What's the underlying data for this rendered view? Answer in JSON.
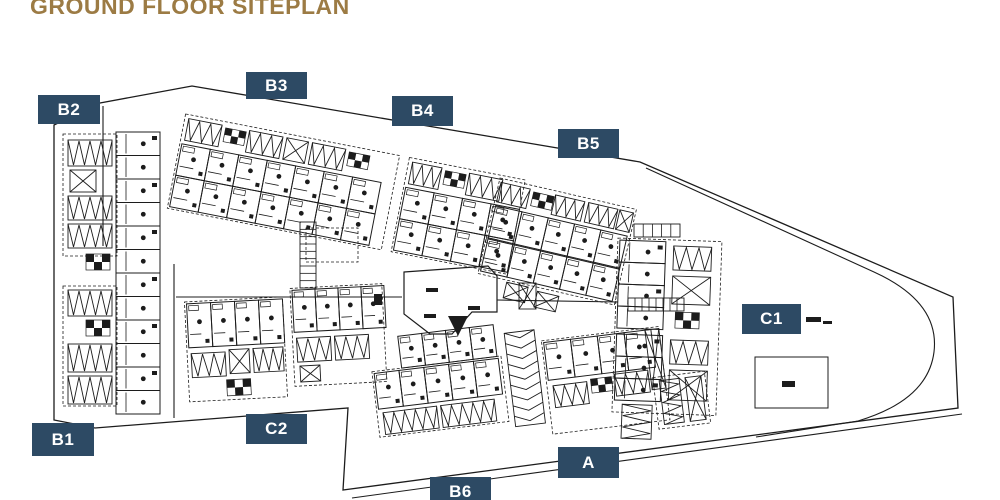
{
  "title": {
    "text": "GROUND FLOOR SITEPLAN",
    "color": "#9c7b44"
  },
  "badges": {
    "bg_color": "#2d4a64",
    "text_color": "#ffffff",
    "items": [
      {
        "id": "B2",
        "label": "B2",
        "x": 38,
        "y": 95,
        "w": 62,
        "h": 29
      },
      {
        "id": "B3",
        "label": "B3",
        "x": 246,
        "y": 72,
        "w": 61,
        "h": 27
      },
      {
        "id": "B4",
        "label": "B4",
        "x": 392,
        "y": 96,
        "w": 61,
        "h": 30
      },
      {
        "id": "B5",
        "label": "B5",
        "x": 558,
        "y": 129,
        "w": 61,
        "h": 29
      },
      {
        "id": "C1",
        "label": "C1",
        "x": 742,
        "y": 304,
        "w": 59,
        "h": 30
      },
      {
        "id": "B1",
        "label": "B1",
        "x": 32,
        "y": 423,
        "w": 62,
        "h": 33
      },
      {
        "id": "C2",
        "label": "C2",
        "x": 246,
        "y": 414,
        "w": 61,
        "h": 30
      },
      {
        "id": "A",
        "label": "A",
        "x": 558,
        "y": 447,
        "w": 61,
        "h": 31
      },
      {
        "id": "B6",
        "label": "B6",
        "x": 430,
        "y": 477,
        "w": 61,
        "h": 30
      }
    ]
  },
  "plan": {
    "stroke_color": "#1c1c1c",
    "boundary": "54,125 100,103 192,86 640,162 953,297 958,408 343,490 348,408 95,428 54,420",
    "roads": [
      "M646,168 L874,272 Q940,302 934,352 Q928,400 858,421 L756,437",
      "M352,498 L962,414",
      "M174,264 L174,418",
      "M103,106 L103,246",
      "M176,297 L402,297",
      "M497,300 L618,302"
    ],
    "clusters": [
      {
        "id": "block-b2-b1-strip",
        "x": 62,
        "y": 128,
        "angle": 0,
        "items": [
          {
            "t": "drect",
            "x": 1,
            "y": 6,
            "w": 54,
            "h": 122
          },
          {
            "t": "drect",
            "x": 1,
            "y": 158,
            "w": 54,
            "h": 120
          },
          {
            "t": "ucol",
            "x": 54,
            "y": 4,
            "n": 12,
            "cw": 44,
            "ch": 23.5
          },
          {
            "t": "zig",
            "x": 6,
            "y": 12,
            "w": 44,
            "h": 26
          },
          {
            "t": "xbox",
            "x": 8,
            "y": 42,
            "w": 26,
            "h": 22
          },
          {
            "t": "zig",
            "x": 6,
            "y": 68,
            "w": 44,
            "h": 24
          },
          {
            "t": "zig",
            "x": 6,
            "y": 96,
            "w": 44,
            "h": 24
          },
          {
            "t": "chk",
            "x": 24,
            "y": 126,
            "s": 8,
            "r": 2,
            "c": 3
          },
          {
            "t": "zig",
            "x": 6,
            "y": 162,
            "w": 44,
            "h": 26
          },
          {
            "t": "chk",
            "x": 24,
            "y": 192,
            "s": 8,
            "r": 2,
            "c": 3
          },
          {
            "t": "zig",
            "x": 6,
            "y": 216,
            "w": 44,
            "h": 28
          },
          {
            "t": "zig",
            "x": 6,
            "y": 248,
            "w": 44,
            "h": 28
          }
        ]
      },
      {
        "id": "block-b3-b4-band",
        "x": 186,
        "y": 112,
        "angle": 11,
        "items": [
          {
            "t": "drect",
            "x": 0,
            "y": 2,
            "w": 218,
            "h": 96
          },
          {
            "t": "zig",
            "x": 4,
            "y": 6,
            "w": 34,
            "h": 22
          },
          {
            "t": "chk",
            "x": 42,
            "y": 8,
            "s": 7,
            "r": 2,
            "c": 3
          },
          {
            "t": "zig",
            "x": 66,
            "y": 6,
            "w": 34,
            "h": 22
          },
          {
            "t": "xbox",
            "x": 104,
            "y": 6,
            "w": 22,
            "h": 22
          },
          {
            "t": "zig",
            "x": 130,
            "y": 6,
            "w": 34,
            "h": 22
          },
          {
            "t": "chk",
            "x": 168,
            "y": 8,
            "s": 7,
            "r": 2,
            "c": 3
          },
          {
            "t": "urow",
            "x": 2,
            "y": 32,
            "n": 7,
            "cw": 29,
            "ch": 32
          },
          {
            "t": "urow",
            "x": 2,
            "y": 64,
            "n": 7,
            "cw": 29,
            "ch": 32
          },
          {
            "t": "drect",
            "x": 228,
            "y": 2,
            "w": 118,
            "h": 96
          },
          {
            "t": "zig",
            "x": 232,
            "y": 6,
            "w": 30,
            "h": 22
          },
          {
            "t": "chk",
            "x": 266,
            "y": 8,
            "s": 7,
            "r": 2,
            "c": 3
          },
          {
            "t": "zig",
            "x": 290,
            "y": 6,
            "w": 34,
            "h": 22
          },
          {
            "t": "urow",
            "x": 230,
            "y": 32,
            "n": 4,
            "cw": 29,
            "ch": 32
          },
          {
            "t": "urow",
            "x": 230,
            "y": 64,
            "n": 4,
            "cw": 29,
            "ch": 32
          }
        ]
      },
      {
        "id": "block-b5-band",
        "x": 500,
        "y": 178,
        "angle": 13,
        "items": [
          {
            "t": "drect",
            "x": 0,
            "y": 0,
            "w": 140,
            "h": 98
          },
          {
            "t": "zig",
            "x": 2,
            "y": 4,
            "w": 30,
            "h": 20
          },
          {
            "t": "chk",
            "x": 36,
            "y": 6,
            "s": 7,
            "r": 2,
            "c": 3
          },
          {
            "t": "zig",
            "x": 58,
            "y": 4,
            "w": 30,
            "h": 20
          },
          {
            "t": "zig",
            "x": 92,
            "y": 4,
            "w": 30,
            "h": 20
          },
          {
            "t": "xbox",
            "x": 124,
            "y": 4,
            "w": 14,
            "h": 20
          },
          {
            "t": "urow",
            "x": 2,
            "y": 28,
            "n": 5,
            "cw": 27,
            "ch": 33
          },
          {
            "t": "urow",
            "x": 2,
            "y": 62,
            "n": 5,
            "cw": 27,
            "ch": 33
          },
          {
            "t": "xbox",
            "x": 30,
            "y": 100,
            "w": 22,
            "h": 16
          },
          {
            "t": "xbox",
            "x": 62,
            "y": 102,
            "w": 22,
            "h": 16
          }
        ]
      },
      {
        "id": "block-c1-strip",
        "x": 618,
        "y": 238,
        "angle": 2,
        "items": [
          {
            "t": "drect",
            "x": 0,
            "y": 0,
            "w": 104,
            "h": 174
          },
          {
            "t": "ucol",
            "x": 2,
            "y": 2,
            "n": 4,
            "cw": 46,
            "ch": 22
          },
          {
            "t": "ucol",
            "x": 2,
            "y": 96,
            "n": 3,
            "cw": 46,
            "ch": 22
          },
          {
            "t": "zig",
            "x": 56,
            "y": 6,
            "w": 38,
            "h": 24
          },
          {
            "t": "xbox",
            "x": 56,
            "y": 36,
            "w": 38,
            "h": 28
          },
          {
            "t": "chk",
            "x": 60,
            "y": 72,
            "s": 8,
            "r": 2,
            "c": 3
          },
          {
            "t": "zig",
            "x": 56,
            "y": 100,
            "w": 38,
            "h": 24
          },
          {
            "t": "xbox",
            "x": 56,
            "y": 130,
            "w": 38,
            "h": 30
          },
          {
            "t": "vzig",
            "x": 10,
            "y": 166,
            "w": 30,
            "h": 34
          }
        ]
      },
      {
        "id": "block-c2-cluster",
        "x": 184,
        "y": 294,
        "angle": -3,
        "items": [
          {
            "t": "drect",
            "x": 0,
            "y": 8,
            "w": 98,
            "h": 100
          },
          {
            "t": "urow",
            "x": 2,
            "y": 10,
            "n": 4,
            "cw": 24,
            "ch": 44
          },
          {
            "t": "zig",
            "x": 4,
            "y": 60,
            "w": 34,
            "h": 24
          },
          {
            "t": "xbox",
            "x": 42,
            "y": 58,
            "w": 20,
            "h": 24
          },
          {
            "t": "zig",
            "x": 66,
            "y": 58,
            "w": 30,
            "h": 24
          },
          {
            "t": "chk",
            "x": 38,
            "y": 88,
            "s": 8,
            "r": 2,
            "c": 3
          },
          {
            "t": "drect",
            "x": 106,
            "y": 0,
            "w": 92,
            "h": 98
          },
          {
            "t": "urow",
            "x": 108,
            "y": 2,
            "n": 4,
            "cw": 23,
            "ch": 42
          },
          {
            "t": "zig",
            "x": 110,
            "y": 50,
            "w": 34,
            "h": 24
          },
          {
            "t": "zig",
            "x": 148,
            "y": 50,
            "w": 34,
            "h": 24
          },
          {
            "t": "xbox",
            "x": 112,
            "y": 78,
            "w": 20,
            "h": 16
          }
        ]
      },
      {
        "id": "block-a-b6-band",
        "x": 368,
        "y": 340,
        "angle": -7,
        "items": [
          {
            "t": "urow",
            "x": 30,
            "y": 0,
            "n": 4,
            "cw": 24,
            "ch": 32
          },
          {
            "t": "drect",
            "x": 0,
            "y": 32,
            "w": 130,
            "h": 66
          },
          {
            "t": "urow",
            "x": 2,
            "y": 34,
            "n": 5,
            "cw": 25,
            "ch": 36
          },
          {
            "t": "zig",
            "x": 6,
            "y": 74,
            "w": 54,
            "h": 22
          },
          {
            "t": "zig",
            "x": 64,
            "y": 74,
            "w": 54,
            "h": 22
          },
          {
            "t": "chev",
            "x": 136,
            "y": 10,
            "w": 30,
            "h": 94,
            "n": 9
          },
          {
            "t": "drect",
            "x": 172,
            "y": 22,
            "w": 118,
            "h": 94
          },
          {
            "t": "urow",
            "x": 174,
            "y": 24,
            "n": 4,
            "cw": 27,
            "ch": 38
          },
          {
            "t": "zig",
            "x": 178,
            "y": 68,
            "w": 34,
            "h": 22
          },
          {
            "t": "chk",
            "x": 216,
            "y": 66,
            "s": 7,
            "r": 2,
            "c": 3
          },
          {
            "t": "zig",
            "x": 240,
            "y": 64,
            "w": 34,
            "h": 22
          },
          {
            "t": "xbox",
            "x": 276,
            "y": 24,
            "w": 14,
            "h": 60
          },
          {
            "t": "drect",
            "x": 278,
            "y": 72,
            "w": 52,
            "h": 52
          },
          {
            "t": "vzig",
            "x": 284,
            "y": 76,
            "w": 20,
            "h": 44
          },
          {
            "t": "xbox",
            "x": 310,
            "y": 76,
            "w": 16,
            "h": 44
          }
        ]
      },
      {
        "id": "central-clubhouse",
        "x": 0,
        "y": 0,
        "angle": 0,
        "items": [
          {
            "t": "poly",
            "pts": "404,272 488,266 497,276 497,312 472,312 452,334 430,334 404,314"
          },
          {
            "t": "fpoly",
            "pts": "448,316 468,316 458,336"
          },
          {
            "t": "solid",
            "x": 426,
            "y": 288,
            "w": 12,
            "h": 4
          },
          {
            "t": "solid",
            "x": 424,
            "y": 314,
            "w": 12,
            "h": 4
          },
          {
            "t": "solid",
            "x": 468,
            "y": 306,
            "w": 12,
            "h": 4
          },
          {
            "t": "solid",
            "x": 374,
            "y": 294,
            "w": 8,
            "h": 11
          }
        ]
      },
      {
        "id": "misc-marks",
        "x": 0,
        "y": 0,
        "angle": 0,
        "items": [
          {
            "t": "ladder",
            "x": 628,
            "y": 298,
            "w": 56,
            "h": 13,
            "n": 8
          },
          {
            "t": "ladder",
            "x": 300,
            "y": 222,
            "w": 16,
            "h": 66,
            "n": 9
          },
          {
            "t": "ladder",
            "x": 634,
            "y": 224,
            "w": 46,
            "h": 13,
            "n": 5
          },
          {
            "t": "drect",
            "x": 306,
            "y": 228,
            "w": 52,
            "h": 34
          },
          {
            "t": "rect",
            "x": 755,
            "y": 357,
            "w": 73,
            "h": 51
          },
          {
            "t": "solid",
            "x": 782,
            "y": 381,
            "w": 13,
            "h": 6
          },
          {
            "t": "solid",
            "x": 806,
            "y": 317,
            "w": 15,
            "h": 5
          },
          {
            "t": "solid",
            "x": 823,
            "y": 321,
            "w": 9,
            "h": 3
          },
          {
            "t": "xbox",
            "x": 519,
            "y": 283,
            "w": 17,
            "h": 26
          }
        ]
      }
    ]
  }
}
